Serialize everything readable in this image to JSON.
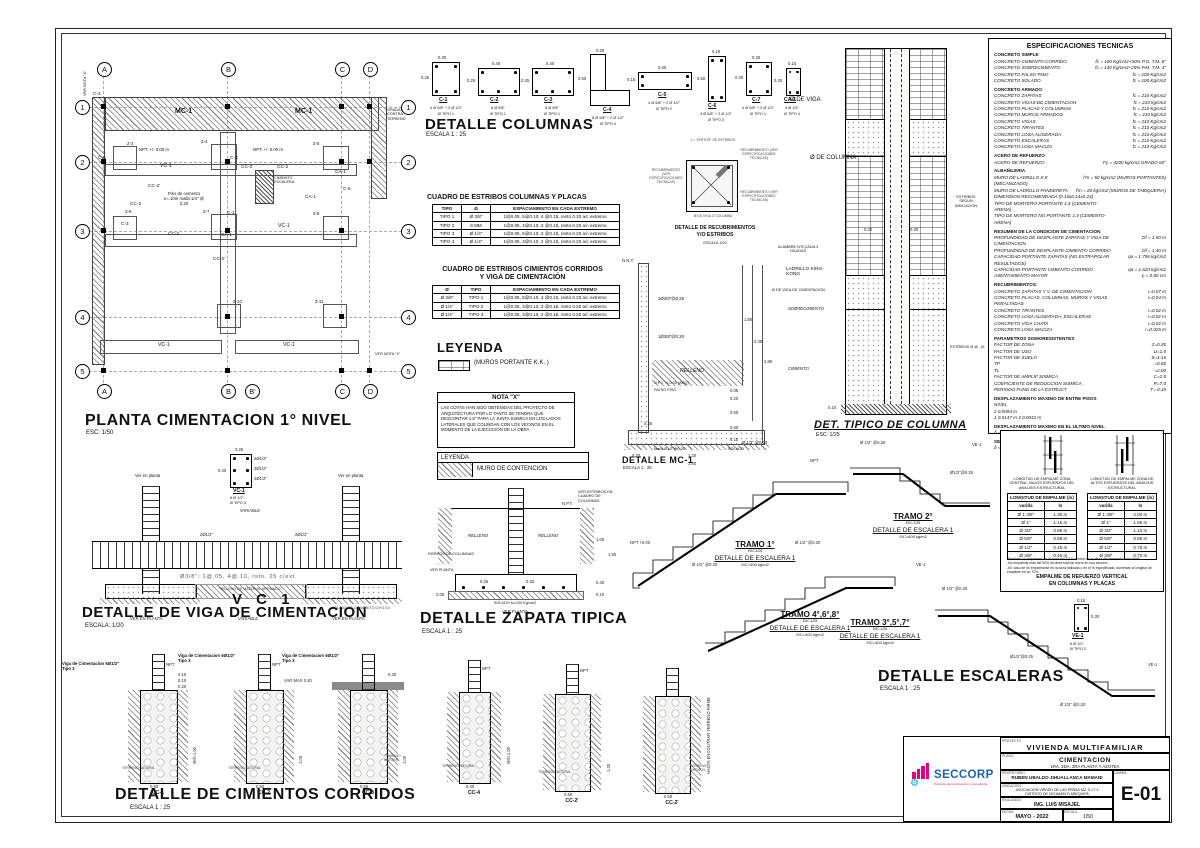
{
  "plan": {
    "title": "PLANTA CIMENTACION 1° NIVEL",
    "scale": "ESC: 1/50",
    "axes_top": [
      "A",
      "B",
      "C",
      "D"
    ],
    "axes_bottom": [
      "A",
      "B",
      "B'",
      "C",
      "D"
    ],
    "axes_side": [
      "1",
      "2",
      "3",
      "4",
      "5"
    ],
    "labels": [
      "MC-1",
      "MC-1",
      "VC-1",
      "VC-1",
      "VC-1",
      "VC-1",
      "CC-2",
      "CC-2",
      "CC-2",
      "CC-2'",
      "CC-2'",
      "CC-3",
      "CA-1",
      "CA-1",
      "CA-1",
      "C-1",
      "C-2",
      "C-3",
      "C-4",
      "C-5",
      "C-6",
      "Z-3",
      "Z-4",
      "Z-5",
      "Z-6",
      "Z-7",
      "Z-8",
      "Z-10",
      "Z-11",
      "NPT. +/- 0.00 m",
      "NPT. +/- 0.00 m",
      "Piso de cemento e=.10m malla 1/4\" @ 0.20",
      "CIMIENTO ESCALERA",
      "GRADAS CONTRA TERRENO",
      "VER NOTA \"X\"",
      "VER NOTA \"X\""
    ]
  },
  "columns": {
    "title": "DETALLE COLUMNAS",
    "scale": "ESCALA 1 : 25",
    "items": [
      {
        "name": "C-1",
        "w": "0.30",
        "h": "0.25",
        "rebar": "4 Ø 5/8\" + 2 Ø 1/2\"",
        "tipo": "Ø TIPO 1"
      },
      {
        "name": "C-2",
        "w": "0.40",
        "h": "0.25",
        "rebar": "6 Ø 5/8\"",
        "tipo": "Ø TIPO 1"
      },
      {
        "name": "C-3",
        "w": "0.40",
        "h": "0.25",
        "rebar": "6 Ø 5/8\"",
        "tipo": "Ø TIPO 1"
      },
      {
        "name": "C-4",
        "w": "0.30",
        "h": "0.50",
        "rebar": "8 Ø 5/8\" + 2 Ø 1/2\"",
        "tipo": "Ø TIPO 4"
      },
      {
        "name": "C-5",
        "w": "0.60",
        "h": "0.15",
        "rebar": "4 Ø 5/8\" + 2 Ø 1/2\"",
        "tipo": "Ø TIPO 2"
      },
      {
        "name": "C-6",
        "w": "0.15",
        "h": "0.50",
        "rebar": "4 Ø 5/8\" + 2 Ø 1/2\"",
        "tipo": "Ø TIPO 2"
      },
      {
        "name": "C-7",
        "w": "0.25",
        "h": "0.30",
        "rebar": "4 Ø 5/8\" + 2 Ø 1/2\"",
        "tipo": "Ø TIPO 1"
      },
      {
        "name": "CA-1",
        "w": "0.15",
        "h": "0.25",
        "rebar": "4 Ø 1/2\"",
        "tipo": "Ø TIPO 4"
      }
    ]
  },
  "tabla_estribos_columnas": {
    "title": "CUADRO DE ESTRIBOS COLUMNAS Y PLACAS",
    "headers": [
      "TIPO",
      "Ø",
      "ESPACIAMIENTO EN CADA EXTREMO"
    ],
    "rows": [
      [
        "TIPO 1",
        "Ø 3/8\"",
        "1@0.05, 5@0.10, 4 @0.15,  resto 0.20  a/c extremo"
      ],
      [
        "TIPO 2",
        "8 MM",
        "1@0.05, 4@0.10, 3 @0.15,  resto 0.20  a/c extremo"
      ],
      [
        "TIPO 3",
        "Ø 1/4\"",
        "1@0.05, 5@0.10, 3 @0.15,  resto 0.20  a/c extremo"
      ],
      [
        "TIPO 4",
        "Ø 1/4\"",
        "1@0.05, 3@0.10, 2 @0.15,  resto 0.20  a/c extremo"
      ]
    ]
  },
  "tabla_estribos_cimientos": {
    "title1": "CUADRO DE ESTRIBOS CIMIENTOS CORRIDOS",
    "title2": "Y VIGA DE CIMENTACIÓN",
    "headers": [
      "Ø",
      "TIPO",
      "ESPACIAMIENTO EN CADA EXTREMO"
    ],
    "rows": [
      [
        "Ø 3/8\"",
        "TIPO 1",
        "1@0.05, 5@0.10, 4 @0.15,  resto 0.20  a/c extremo"
      ],
      [
        "Ø 1/4\"",
        "TIPO 2",
        "1@0.05, 3@0.10, 3 @0.15,  resto 0.20  a/c extremo"
      ],
      [
        "Ø 1/4\"",
        "TIPO 3",
        "1@0.05, 3@0.10, 2 @0.15,  resto 0.20  a/c extremo"
      ]
    ]
  },
  "leyenda": {
    "title": "LEYENDA",
    "muros": "(MUROS  PORTANTE  K.K. )"
  },
  "nota_x": {
    "title": "NOTA \"X\"",
    "body": "LAS COTAS HAN SIDO OBTENIDAS DEL PROYECTO DE ARQUITECTURA POR LO TANTO SE TENDRA QUE DESCONTAR 1.5\" PARA LA JUNTA SISMICA EN LOS LADOS LATERALES QUE COLINDAN CON LOS VECINOS EN EL MOMENTO DE LA EJECUCION DE LA OBRA"
  },
  "leyenda2": {
    "header": "LEYENDA",
    "item": "MURO DE CONTENCION"
  },
  "recubrimientos": {
    "title1": "DETALLE DE RECUBRIMIENTOS",
    "title2": "Y/O ESTRIBOS",
    "scale": "ESCALA   1/20",
    "l_note": "L = VER ESP. DE ESTRIBOS",
    "recub": "RECUBRIMIENTO (VER ESPECIFICACIONES TECNICAS)",
    "viga_note": "Ø DE VIGA O COLUMNA"
  },
  "mc1": {
    "title": "DETALLE MC-1",
    "scale": "ESCALA 1 : 25",
    "labels": [
      "N.N.T.",
      "1Ø3/8\"@0.25",
      "1Ø3/8\"@0.30",
      "N.P.T. +/-0.00 (ARQ)",
      "FALSO PISO",
      "RELLENO",
      "Malla Ø1/2\"@0.25",
      "SOLADO"
    ],
    "dims": [
      "1.80",
      "2.35",
      "2.85",
      "0.05",
      "0.20",
      "0.50",
      "0.60",
      "0.10",
      "0.20",
      "1.20",
      "1.40",
      "0.25"
    ]
  },
  "det_tipico": {
    "title": "DET. TIPICO DE COLUMNA",
    "scale": "ESC: 1/25",
    "labels": [
      "Ø DE VIGA",
      "Ø DE COLUMNA",
      "ALAMBRE N°8 CADA 3 HILADAS",
      "LADRILLO KING-KONG",
      "Ø DE VIGA DE CIMENTACION",
      "SOBRECIMIENTO",
      "CIMIENTO",
      "ESTRIBOS SEGUN INDICACION",
      "ESTRIBOS Ø @ .15"
    ],
    "dims": [
      "0.30",
      "0.30",
      "0.10"
    ]
  },
  "especificaciones": {
    "title": "ESPECIFICACIONES   TECNICAS",
    "lines": [
      {
        "c": "h",
        "l": "CONCRETO SIMPLE",
        "v": ""
      },
      {
        "c": "i",
        "l": "CONCRETO CIMIENTO CORRIDO",
        "v": "fc = 100 Kg/cm2+30% P.G. T.M. 6\""
      },
      {
        "c": "i",
        "l": "CONCRETO SOBRECIMIENTO",
        "v": "fc = 140 Kg/cm2+25% P.M. T.M. 4\""
      },
      {
        "c": "i",
        "l": "CONCRETO FALSO PISO",
        "v": "fc = 100 Kg/cm2"
      },
      {
        "c": "i",
        "l": "CONCRETO SOLADO",
        "v": "fc = 100 Kg/cm2"
      },
      {
        "c": "h",
        "l": "CONCRETO ARMADO",
        "v": ""
      },
      {
        "c": "i",
        "l": "CONCRETO ZAPATAS",
        "v": "fc = 210 Kg/cm2"
      },
      {
        "c": "i",
        "l": "CONCRETO VIGAS DE CIMENTACION",
        "v": "fc = 210 kg/cm2"
      },
      {
        "c": "i",
        "l": "CONCRETO PLACAS Y COLUMNAS",
        "v": "fc = 210 Kg/cm2"
      },
      {
        "c": "i",
        "l": "CONCRETO MUROS ARMADOS",
        "v": "fc = 210 kg/cm2"
      },
      {
        "c": "i",
        "l": "CONCRETO VIGAS",
        "v": "fc = 210 Kg/cm2"
      },
      {
        "c": "i",
        "l": "CONCRETO TIRANTES",
        "v": "fc = 210 Kg/cm2"
      },
      {
        "c": "i",
        "l": "CONCRETO LOSA ALIGERADA",
        "v": "fc = 210 Kg/cm2"
      },
      {
        "c": "i",
        "l": "CONCRETO ESCALERAS",
        "v": "fc = 210 Kg/cm2"
      },
      {
        "c": "i",
        "l": "CONCRETO LOSA MACIZA",
        "v": "fc = 210 Kg/cm2"
      },
      {
        "c": "h",
        "l": "ACERO DE REFUERZO",
        "v": ""
      },
      {
        "c": "i",
        "l": "ACERO DE REFUERZO",
        "v": "Fy = 4200 kg/cm2   GRADO 60°"
      },
      {
        "c": "h",
        "l": "ALBAÑILERIA",
        "v": ""
      },
      {
        "c": "i",
        "l": "MURO DE LADRILLO K.K (MECANIZADO)",
        "v": "f'm = 50 kg/cm2 (MUROS PORTANTES)"
      },
      {
        "c": "i",
        "l": "MURO DE LADRILLO PANDERETA",
        "v": "f'm = 20 kg/cm2 (MUROS DE TABIQUERIA)"
      },
      {
        "c": "i",
        "l": "DIMENSION RECOMENDADA (0.10x0.14x0.24)",
        "v": ""
      },
      {
        "c": "i",
        "l": "TIPO DE MORTERO PORTANTE 1:4 (CEMENTO-ARENA)",
        "v": ""
      },
      {
        "c": "i",
        "l": "TIPO DE MORTERO NO PORTANTE 1:4 (CEMENTO-ARENA)",
        "v": ""
      },
      {
        "c": "h",
        "l": "RESUMEN DE LA CONDICION DE CIMENTACION",
        "v": ""
      },
      {
        "c": "i",
        "l": "PROFUNDIDAD DE DESPLANTE ZAPATAS Y VIGA DE CIMENTACION",
        "v": "Df =  1.50 m"
      },
      {
        "c": "i",
        "l": "PROFUNDIDAD DE DESPLANTE CIMIENTO CORRIDO",
        "v": "Df =  1.40 m"
      },
      {
        "c": "i",
        "l": "CAPACIDAD PORTANTE ZAPATAS (NO EXTRAPOLAR RESULTADOS)",
        "v": "qa =  1.796  kg/cm2"
      },
      {
        "c": "i",
        "l": "CAPACIDAD PORTANTE CIMIENTO CORRIDO",
        "v": "qa =  1.620  kg/cm2"
      },
      {
        "c": "i",
        "l": "ASENTAMIENTO MAYOR",
        "v": "p =  0.80 cm"
      },
      {
        "c": "h",
        "l": "RECUBRIMIENTOS:",
        "v": ""
      },
      {
        "c": "i",
        "l": "CONCRETO ZAPATAS Y V. DE CIMENTACION",
        "v": "r=0.07 m"
      },
      {
        "c": "i",
        "l": "CONCRETO PLACAS, COLUMNAS, MUROS Y VIGAS PERALTADAS",
        "v": "r=0.04 m"
      },
      {
        "c": "i",
        "l": "CONCRETO TIRANTES",
        "v": "r=0.02 m"
      },
      {
        "c": "i",
        "l": "CONCRETO LOSA ALIGERADA, ESCALERAS",
        "v": "r=0.02 m"
      },
      {
        "c": "i",
        "l": "CONCRETO VIGA CHATA",
        "v": "r=0.02 m"
      },
      {
        "c": "i",
        "l": "CONCRETO LOSA MACIZA",
        "v": "r=0.025 m"
      },
      {
        "c": "h",
        "l": "PARAMETROS SISMORESISTENTES",
        "v": ""
      },
      {
        "c": "i",
        "l": "FACTOR DE ZONA",
        "v": "Z=0.35"
      },
      {
        "c": "i",
        "l": "FACTOR DE USO",
        "v": "U=1.0"
      },
      {
        "c": "i",
        "l": "FACTOR DE SUELO",
        "v": "S=1.15"
      },
      {
        "c": "i",
        "l": "TP",
        "v": "=0.60"
      },
      {
        "c": "i",
        "l": "TL",
        "v": "=2.00"
      },
      {
        "c": "i",
        "l": "FACTOR DE AMPLIF SISMICA",
        "v": "C=2.5"
      },
      {
        "c": "i",
        "l": "COEFICIENTE DE REDUCCION SISMICA",
        "v": "R=7.0"
      },
      {
        "c": "i",
        "l": "PERIODO FUND DE LA ESTRUCT",
        "v": "T= 0.19"
      },
      {
        "c": "h",
        "l": "DESPLAZAMIENTO MAXIMO DE ENTRE PISOS",
        "v": ""
      },
      {
        "c": "i",
        "l": "NIVEL",
        "v": ""
      },
      {
        "c": "i",
        "l": "2    0.0094 m",
        "v": ""
      },
      {
        "c": "i",
        "l": "1    0.0147 m         3    0.0042 m",
        "v": ""
      },
      {
        "c": "h",
        "l": "DESPLAZAMIENTO MAXIMO EN EL ULTIMO NIVEL",
        "v": ""
      },
      {
        "c": "i",
        "l": "δ =   0.0042 m",
        "v": ""
      },
      {
        "c": "h",
        "l": "SEPARACION MAXIMA A EDIFICACION ALEDAÑA",
        "v": ""
      },
      {
        "c": "i",
        "l": "δ =      1.5\"",
        "v": ""
      }
    ]
  },
  "empalme": {
    "fig_caption_left": "LONGITUD DE EMPALME ZONA CENTRAL, BAJOS ESFUERZOS DEL ANALISIS ESTRUCTURAL",
    "fig_caption_right": "LONGITUD DE EMPALME ZONA DE ALTOS ESFUERZOS DEL ANALISIS ESTRUCTURAL",
    "table_header": "LONGITUD DE EMPALME (ls)",
    "col_varilla": "varilla",
    "col_ls": "ls",
    "rows_central": [
      [
        "Ø 1 3/8\"",
        "1.30 m"
      ],
      [
        "Ø 1\"",
        "1.15 m"
      ],
      [
        "Ø 3/4\"",
        "0.88 m"
      ],
      [
        "Ø 5/8\"",
        "0.58 m"
      ],
      [
        "Ø 1/2\"",
        "0.45 m"
      ],
      [
        "Ø 3/8\"",
        "0.40 m"
      ]
    ],
    "rows_altos": [
      [
        "Ø 1 3/8\"",
        "2.00 m"
      ],
      [
        "Ø 1\"",
        "1.95 m"
      ],
      [
        "Ø 3/4\"",
        "1.10 m"
      ],
      [
        "Ø 5/8\"",
        "0.95 m"
      ],
      [
        "Ø 1/2\"",
        "0.75 m"
      ],
      [
        "Ø 3/8\"",
        "0.70 m"
      ]
    ],
    "notes": [
      "-Realizar los empalmes en la zona del 2/3 H central de la altura del elemento estructural.",
      "-No empalmar mas del 50% del area total de acero en una seccion.",
      "-En caso de no empalmarse en la zona indicada o en el % especificado, aumentar la longitud de empalme en un 70%."
    ],
    "title1": "EMPALME DE REFUERZO VERTICAL",
    "title2": "EN COLUMNAS Y PLACAS"
  },
  "viga": {
    "title": "DETALLE  DE  VIGA DE CIMENTACION",
    "scale": "ESCALA:  1/20",
    "big": "V C 1",
    "stirrups": "Ø3/8\": 1@.05, 4@.10, rsto. 25 c/ext.",
    "relleno": "RELLENO  DE  MATERIAL  AFIRMADO",
    "solado": "SOLADO DE CONCRETO C:H 1:10",
    "variable": "VARIABLE",
    "ver_planta": "VER EN PLANTA",
    "ver_planta_top": "Ver en planta",
    "bar_top": "2Ø1/2\"",
    "bar_mid": "2Ø1/2\"",
    "section": {
      "name": "VC-1",
      "w": "0.25",
      "h": "0.40",
      "rebar": "6 Ø 1/2\"",
      "tipo": "Ø TIPO 3",
      "bars": [
        "2Ø1/2\"",
        "2Ø1/2\"",
        "2Ø1/2\""
      ]
    }
  },
  "zapata": {
    "title": "DETALLE ZAPATA TIPICA",
    "scale": "ESCALA 1 : 25",
    "labels": [
      "VER ESTRIBOS EN CUADRO DE COLUMNAS",
      "RELLENO",
      "RELLENO",
      "FIERROS DE COLUMNAS",
      "VER PLANTA",
      "VER PLANTA",
      "SOLADO  fc=100 Kg/cm2",
      "N.P.T."
    ],
    "dims": [
      "0.25",
      "0.25",
      "1.00",
      "1.50",
      "0.40",
      "0.10",
      "0.05"
    ]
  },
  "escaleras": {
    "title": "DETALLE ESCALERAS",
    "scale": "ESCALA 1 : 25",
    "tramos": [
      {
        "name": "TRAMO 1°",
        "esc": "ESC:1/25",
        "det": "DETALLE DE ESCALERA 1",
        "load": "S/C=400 kg/m2"
      },
      {
        "name": "TRAMO 2°",
        "esc": "ESC:1/25",
        "det": "DETALLE DE ESCALERA 1",
        "load": "S/C=500 kg/m2"
      },
      {
        "name": "TRAMO 4°,6°,8°",
        "esc": "ESC:1/25",
        "det": "DETALLE DE ESCALERA 1",
        "load": "S/C=400 kg/m2"
      },
      {
        "name": "TRAMO 3°,5°,7°",
        "esc": "ESC:1/25",
        "det": "DETALLE DE ESCALERA 1",
        "load": "S/C=400 kg/m2"
      }
    ],
    "callouts": [
      "Ø 1/2\"  @0.20",
      "Ø 1/2\"  @0.20",
      "Ø 1/2\"  @0.20",
      "Ø 1/2\"  @0.20",
      "Ø 1/2\"  @0.20",
      "Ø 1/2\"  @0.20",
      "Ø1/2\"@0.25",
      "Ø1/2\"@0.25",
      "NPT",
      "NPT +0.00",
      "VE-1",
      "VE-1",
      "VE-1"
    ],
    "ve1": {
      "name": "VE-1",
      "rebar": "6 Ø 1/2\"",
      "tipo": "Ø TIPO 2",
      "w": "0.15",
      "h": "0.30"
    }
  },
  "cimientos": {
    "title": "DETALLE DE CIMIENTOS CORRIDOS",
    "scale": "ESCALA 1 : 25",
    "viga_callout": "Viga de Cimentacion 6Ø1/2\" Tipo 3",
    "terreno": "TERRENO NATURAL",
    "firme": "HASTA ENCONTRAR TERRENO FIRME",
    "varmax": "VAR MAX 0.40",
    "npt": "NPT",
    "min": "MIN 1.00",
    "items": [
      {
        "name": "CC-1",
        "w": "0.50"
      },
      {
        "name": "CC-2",
        "w": "0.50"
      },
      {
        "name": "CC-3",
        "w": "0.50"
      },
      {
        "name": "CC-4",
        "w": "0.40"
      },
      {
        "name": "CC-2'",
        "w": "0.50"
      },
      {
        "name": "CC-2'",
        "w": "0.50"
      }
    ],
    "dims": [
      "0.10",
      "0.10",
      "0.20",
      "0.40",
      "1.00",
      "1.20"
    ]
  },
  "title_block": {
    "labels": {
      "proyecto": "PROYECTO",
      "plano": "PLANO",
      "propietario": "PROPIETARIO",
      "ubicacion": "UBICACION",
      "realizado": "REALIZADO",
      "fecha": "FECHA",
      "escala": "ESCALA",
      "lamina": "LAMINA"
    },
    "proyecto": "VIVIENDA  MULTIFAMILIAR",
    "plano1": "CIMENTACION",
    "plano2": "1RA, 2DA, 3RA PLANTA Y AZOTEA",
    "propietario": "RUBEN UBALDO JIHUALLANCA MAMANI",
    "ubicacion1": "ASOCIACION VIRGEN DE LAS PEÑAS MZ. K LT 3",
    "ubicacion2": "DISTRITO DE UCHUMAYO AREQUIPA",
    "realizado": "ING. LUIS MISAJEL",
    "fecha": "MAYO   -   2022",
    "escala": "1/50",
    "lamina": "E-01",
    "logo": {
      "name": "SECCORP",
      "tagline": "Servicios de Construcción y Consultoría",
      "brand_blue": "#1b5fb5",
      "brand_magenta": "#e5007c",
      "brand_cyan": "#00b0e0"
    }
  }
}
